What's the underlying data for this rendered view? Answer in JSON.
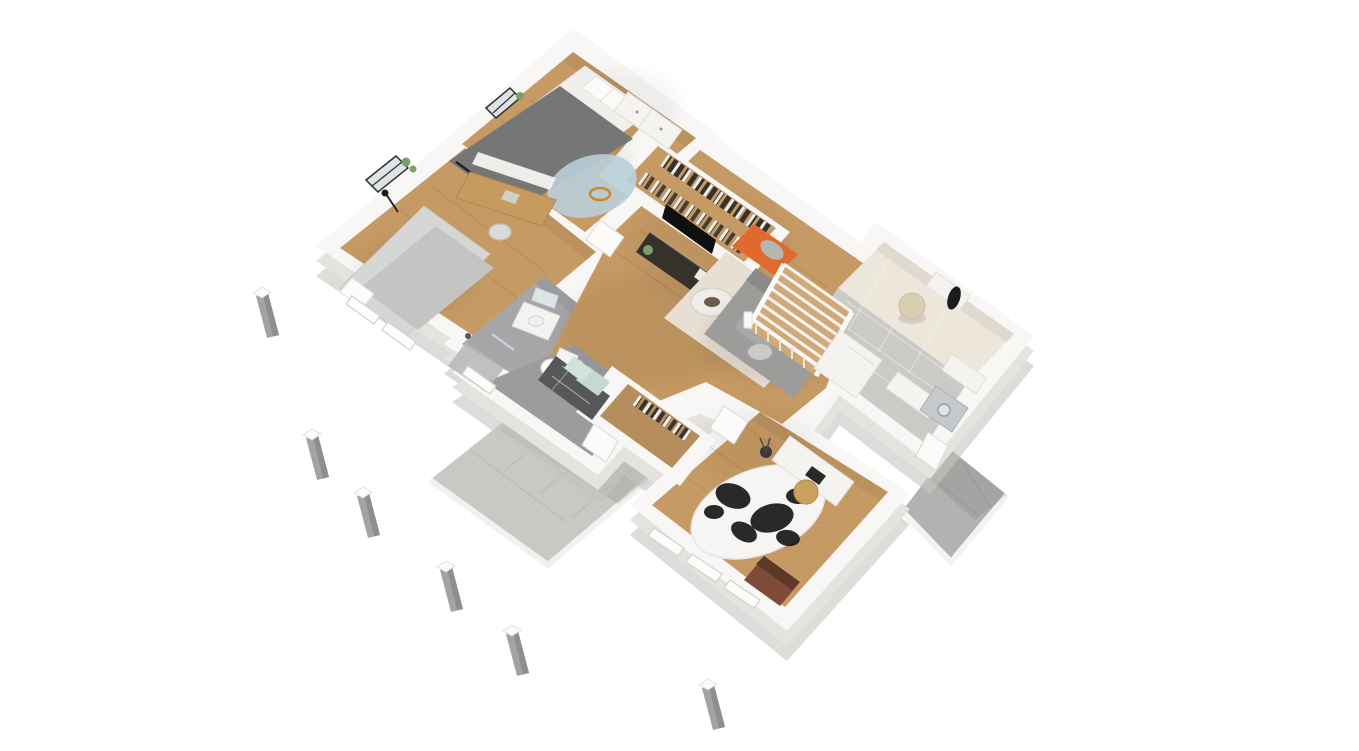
{
  "scene": {
    "type": "3d-floorplan-render",
    "view": "isometric dollhouse cutaway, roof removed",
    "background": "#ffffff",
    "description": "Furnished single-storey house 3D floor plan seen from above at an angle, with white cut walls, oak floors, gray tiled wet areas, a front patio walkway, a back patio and six loose concrete piles on the white ground."
  },
  "palette": {
    "bg": "#ffffff",
    "wall": "#f8f7f5",
    "wall_face": "#e5e3df",
    "wall_slab": "#c8c6c2",
    "wall_inner_warm": "#efe8dc",
    "wood": "#c69a64",
    "wood_light": "#d2a976",
    "tile_gray": "#a6a6a9",
    "tile_dark": "#9c9c9f",
    "tile_light": "#cbcac7",
    "cream": "#ece6db",
    "patio_light": "#cac8c4",
    "patio_dark": "#b3b2b0",
    "rug_blue": "#b9cfd9",
    "rug_beige": "#e7dfd4",
    "rug_cow": "#f6f5f3",
    "sofa": "#9c9c9a",
    "bed_dark": "#767676",
    "bed_light": "#d6d6d4",
    "orange": "#e0692e",
    "desk_wood": "#c79a5f",
    "tan": "#c9a05e",
    "console": "#35312b",
    "brown": "#7d4b37",
    "pile": "#a3a3a5",
    "black": "#222222",
    "plant": "#7da06b",
    "white_furn": "#f5f3ef",
    "glass": "#dce4e6"
  },
  "rooms": [
    {
      "id": "bedroom-1",
      "label": "Bedroom 1",
      "floor": "wood",
      "furniture": [
        "double bed with dark gray duvet",
        "white pillows",
        "two white dressers",
        "round blue rug",
        "wooden toy on rug",
        "window with plant"
      ]
    },
    {
      "id": "walk-in-closet",
      "label": "Walk-in closet",
      "floor": "wood",
      "furniture": [
        "two rails of hanging clothes"
      ]
    },
    {
      "id": "bedroom-2",
      "label": "Bedroom 2 / study",
      "floor": "wood",
      "furniture": [
        "single bed",
        "black floor lamp",
        "wooden desk",
        "chair",
        "wall shelf",
        "window with plants"
      ]
    },
    {
      "id": "bathroom",
      "label": "Bathroom",
      "floor": "gray tile",
      "furniture": [
        "floating vanity with sink",
        "mirror",
        "toilet",
        "walk-in shower"
      ]
    },
    {
      "id": "hallway",
      "label": "Hallway",
      "floor": "wood",
      "furniture": []
    },
    {
      "id": "entry-hall",
      "label": "Entry hall",
      "floor": "gray tile",
      "furniture": [
        "checkered bench",
        "seafoam cushions"
      ]
    },
    {
      "id": "living-room",
      "label": "Living room",
      "floor": "wood",
      "furniture": [
        "gray sofa",
        "beige area rug",
        "two round coffee tables",
        "orange lounge chair with gray throw",
        "flat TV",
        "dark media console",
        "wooden staircase with white railing",
        "white storage cubes"
      ]
    },
    {
      "id": "utility-entry",
      "label": "Rear entry / utility",
      "floor": "cream and light gray tile",
      "furniture": [
        "beige pouf",
        "coat rack shelf with black coat",
        "washing machine",
        "white counter",
        "wall cabinet"
      ]
    },
    {
      "id": "office",
      "label": "Office",
      "floor": "wood",
      "furniture": [
        "white desk",
        "laptop",
        "tan desk chair",
        "cowhide rug",
        "brown leather armchair",
        "twig plant"
      ]
    },
    {
      "id": "storage-closet",
      "label": "Storage closet",
      "floor": "wood",
      "furniture": [
        "shelves with shoes and bags"
      ]
    }
  ],
  "outdoor": {
    "front_patio": {
      "label": "Front patio walkway",
      "floor": "light gray tile"
    },
    "back_patio": {
      "label": "Back patio",
      "floor": "gray tile"
    },
    "piles": {
      "label": "Concrete piles",
      "count": 6
    }
  }
}
